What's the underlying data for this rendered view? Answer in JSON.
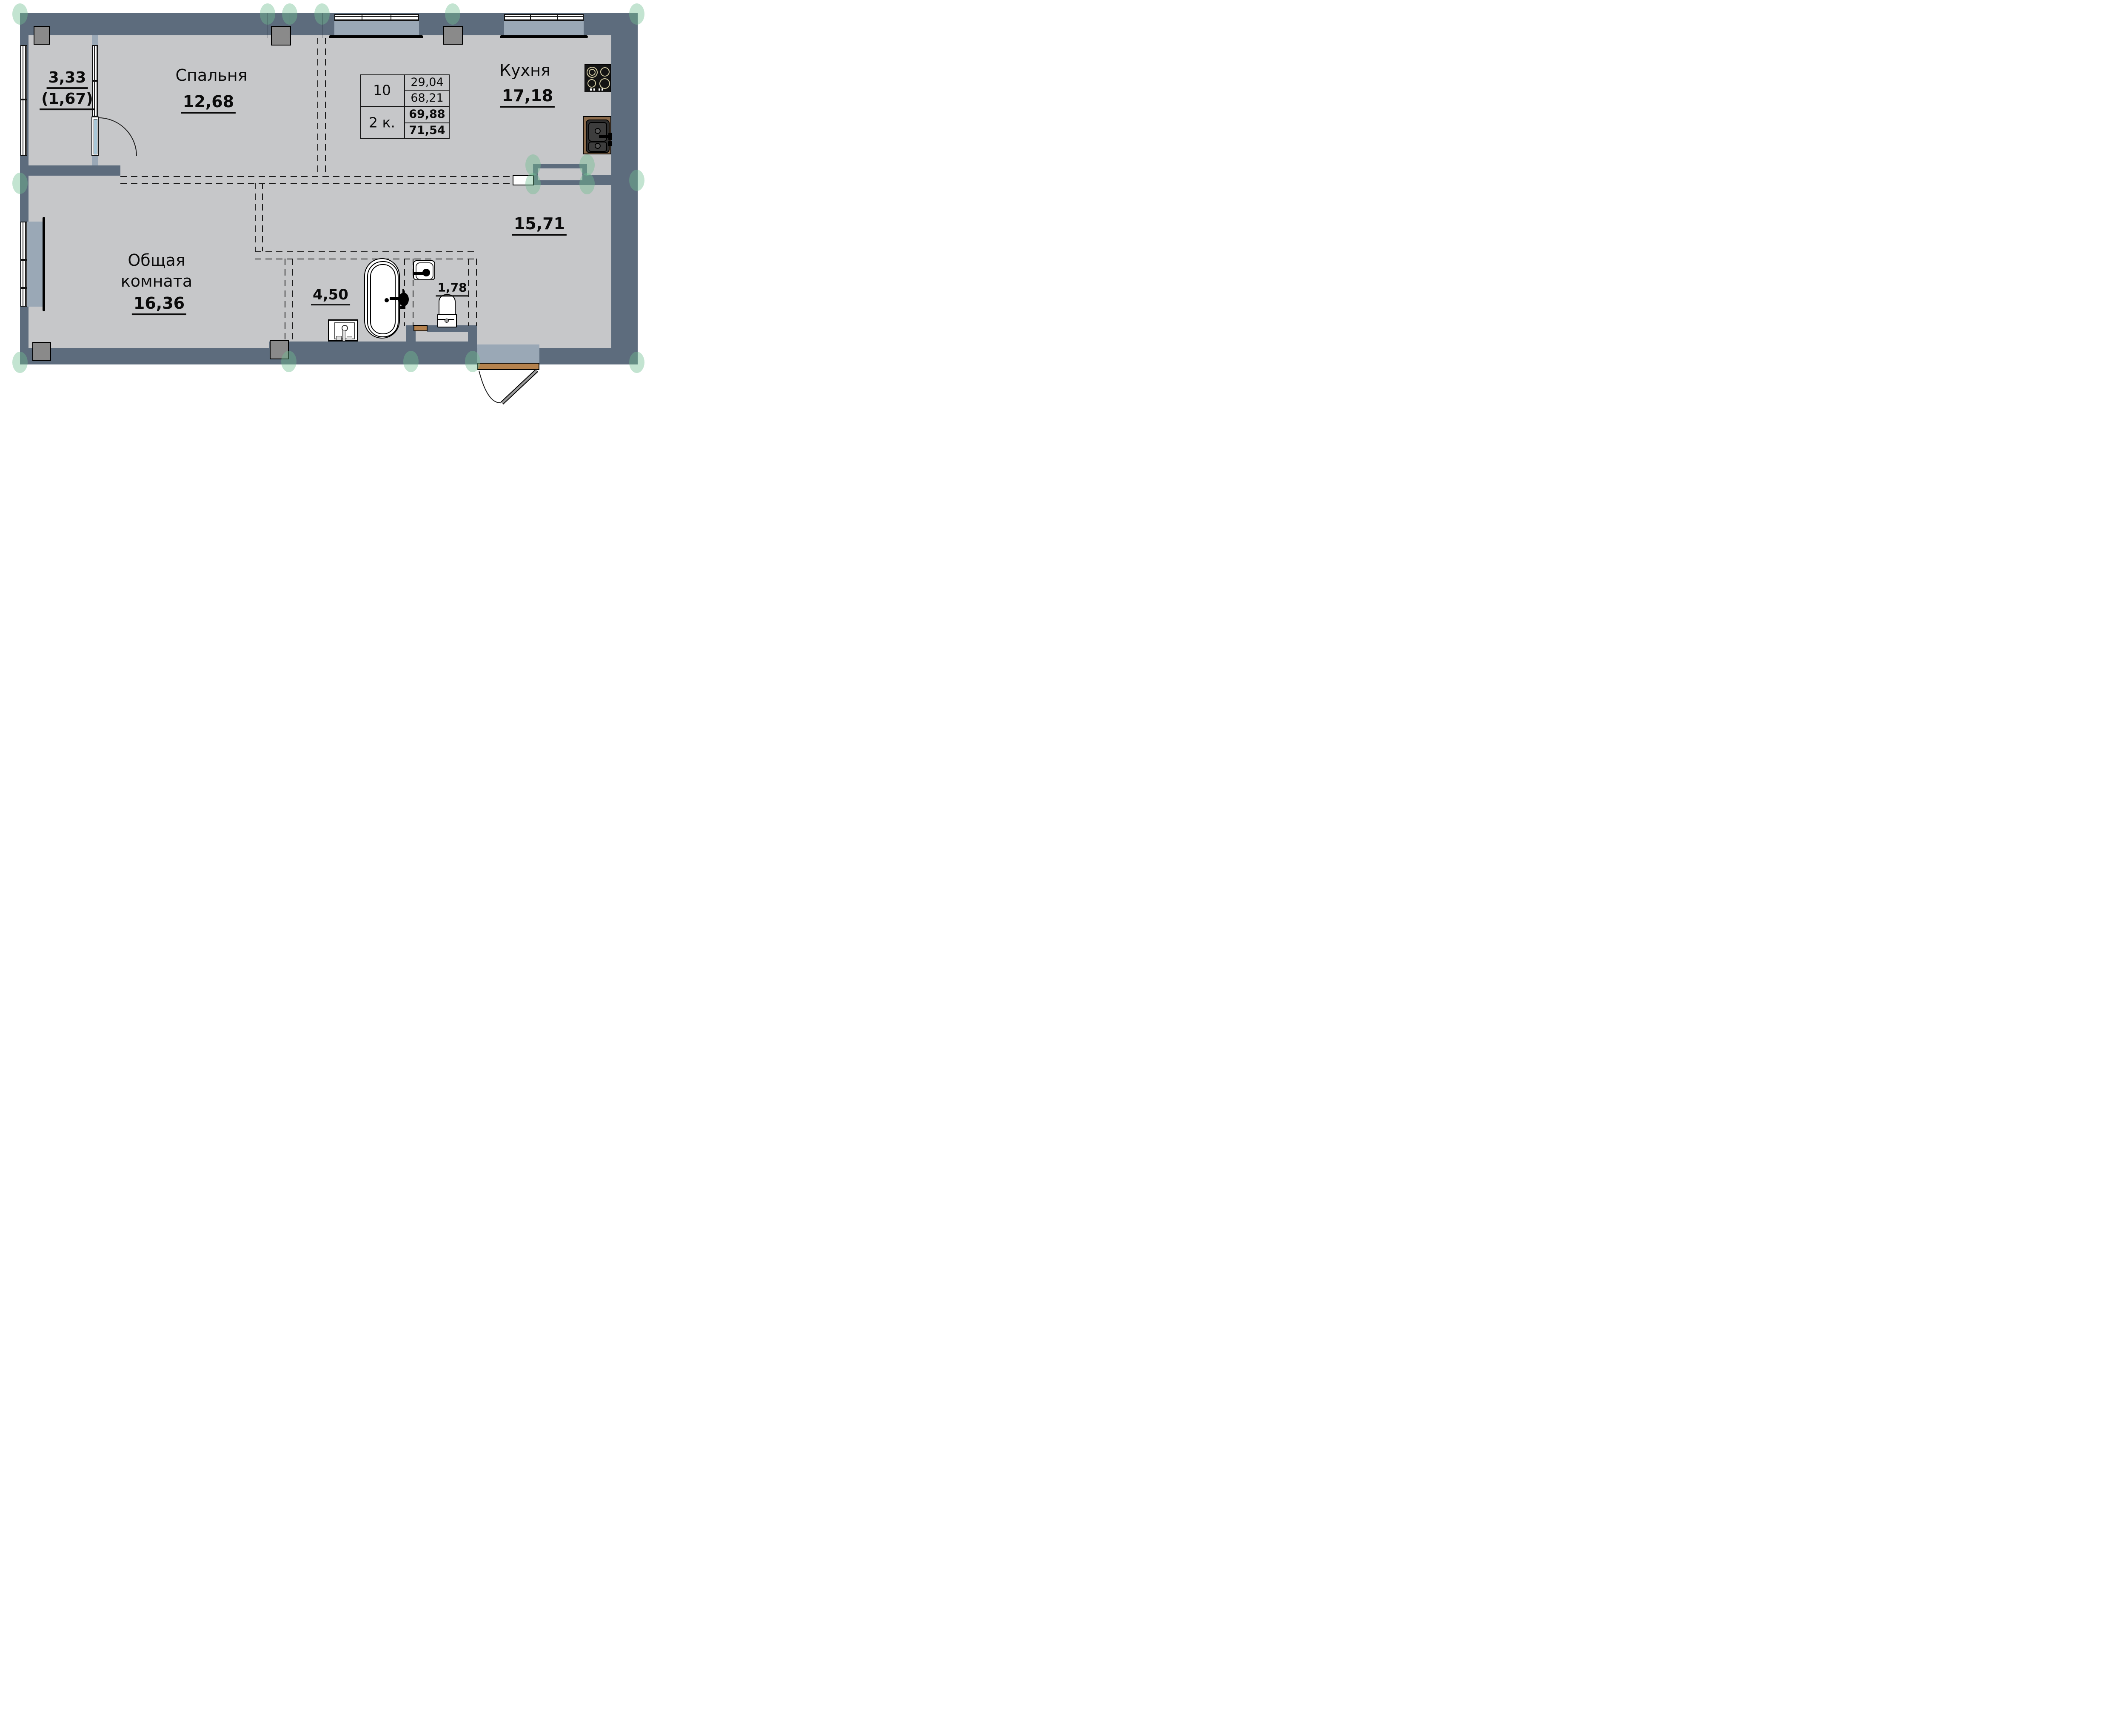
{
  "plan": {
    "title": "apartment floor plan, 2-room unit",
    "rooms": {
      "balcony": {
        "area": "3,33",
        "area_coeff": "(1,67)"
      },
      "bedroom": {
        "name": "Спальня",
        "area": "12,68"
      },
      "kitchen": {
        "name": "Кухня",
        "area": "17,18"
      },
      "hallway": {
        "area": "15,71"
      },
      "living": {
        "name_line1": "Общая",
        "name_line2": "комната",
        "area": "16,36"
      },
      "bathroom": {
        "area": "4,50"
      },
      "wc": {
        "area": "1,78"
      }
    },
    "unit_table": {
      "unit_number": "10",
      "unit_type": "2 к.",
      "living_area": "29,04",
      "area_without_balcony": "68,21",
      "total_area": "69,88",
      "total_area_with_balcony": "71,54"
    },
    "colors": {
      "wall": "#5d6c7d",
      "pier": "#9aa8b6",
      "floor": "#c6c7c9",
      "column": "#8a8a8a",
      "wood_sill": "#b5824e",
      "counter_wood": "#8a6a4b",
      "axis_marker_green": "#6fbf92",
      "door_glass": "#a9c8d8",
      "stove": "#141414"
    }
  }
}
